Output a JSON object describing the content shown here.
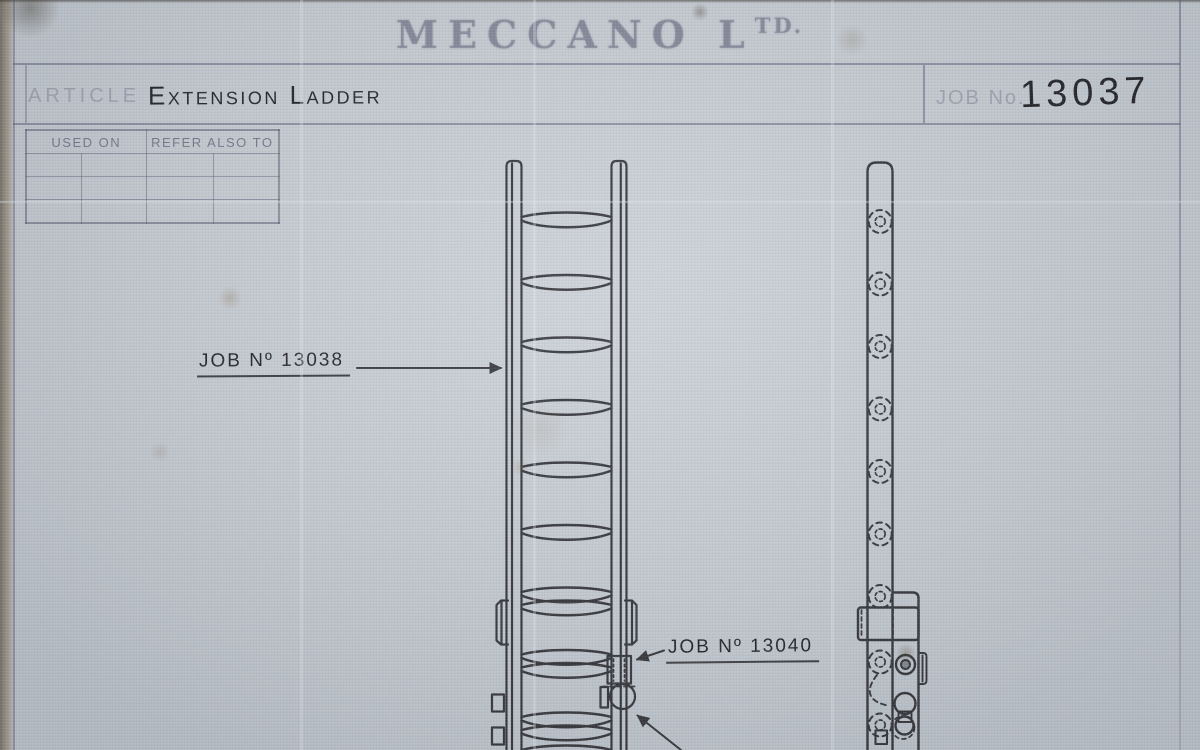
{
  "colors": {
    "paper": "#c4cad0",
    "ink": "#1f2024",
    "printed_line": "#4e526e"
  },
  "logo": {
    "main": "MECCANO L",
    "sup": "TD."
  },
  "title_block": {
    "article_label": "ARTICLE",
    "article_value": "Extension Ladder",
    "job_label": "JOB No.",
    "job_value": "13037"
  },
  "ref_table": {
    "headers": [
      "USED ON",
      "REFER ALSO TO"
    ],
    "rows": [
      [
        "",
        "",
        "",
        ""
      ],
      [
        "",
        "",
        "",
        ""
      ],
      [
        "",
        "",
        "",
        ""
      ]
    ]
  },
  "callouts": {
    "job_13038": "JOB Nº 13038",
    "job_13040": "JOB Nº 13040"
  }
}
